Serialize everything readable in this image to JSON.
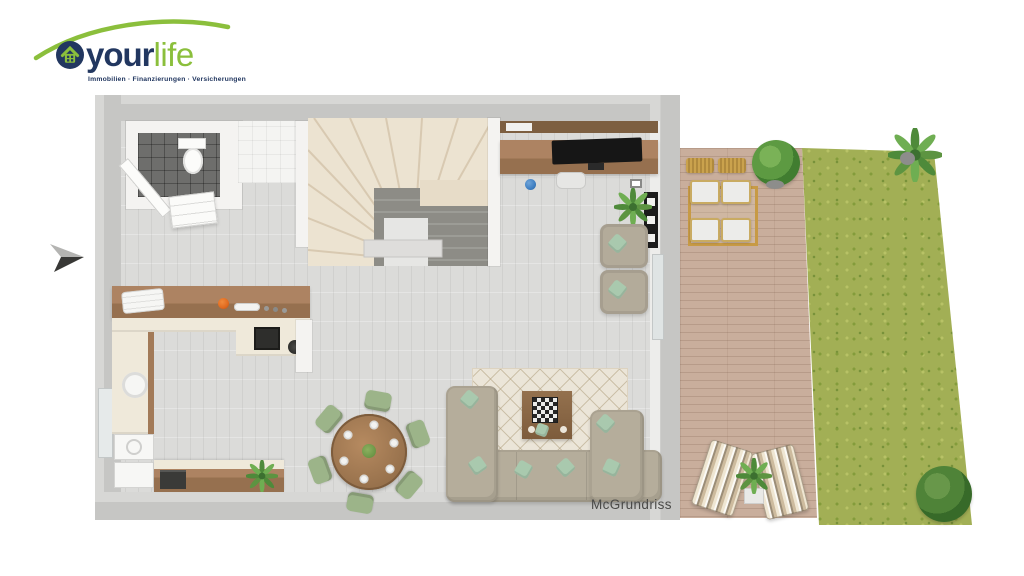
{
  "header": {
    "logo": {
      "brand_primary": "your",
      "brand_secondary": "life",
      "tagline": "Immobilien · Finanzierungen · Versicherungen",
      "colors": {
        "navy": "#223760",
        "green": "#8bbf3c"
      }
    }
  },
  "plan": {
    "watermark": "McGrundriss",
    "scene": "3d-top-down-floorplan-ground-floor-with-terrace-and-garden",
    "colors": {
      "exterior_wall": "#c6c6c4",
      "interior_wall": "#f4f3f1",
      "floor": "#dbdbd9",
      "wc_tiles": "#6e6e6c",
      "stairs_upper": "#ece3d1",
      "stairs_lower": "#8d8c86",
      "kitchen_worktop": "#a27a58",
      "cabinet_front": "#efe9da",
      "sofa": "#b5ad9b",
      "accent_pillow": "#a9c9ae",
      "dining_chair": "#9cb489",
      "rug": "#ebe5d8",
      "terrace_deck": "#c9ae9c",
      "lawn": "#a2af55",
      "plant_green": "#5d9441",
      "kettle_orange": "#e06a1f",
      "globe_blue": "#3f7fc2"
    }
  }
}
